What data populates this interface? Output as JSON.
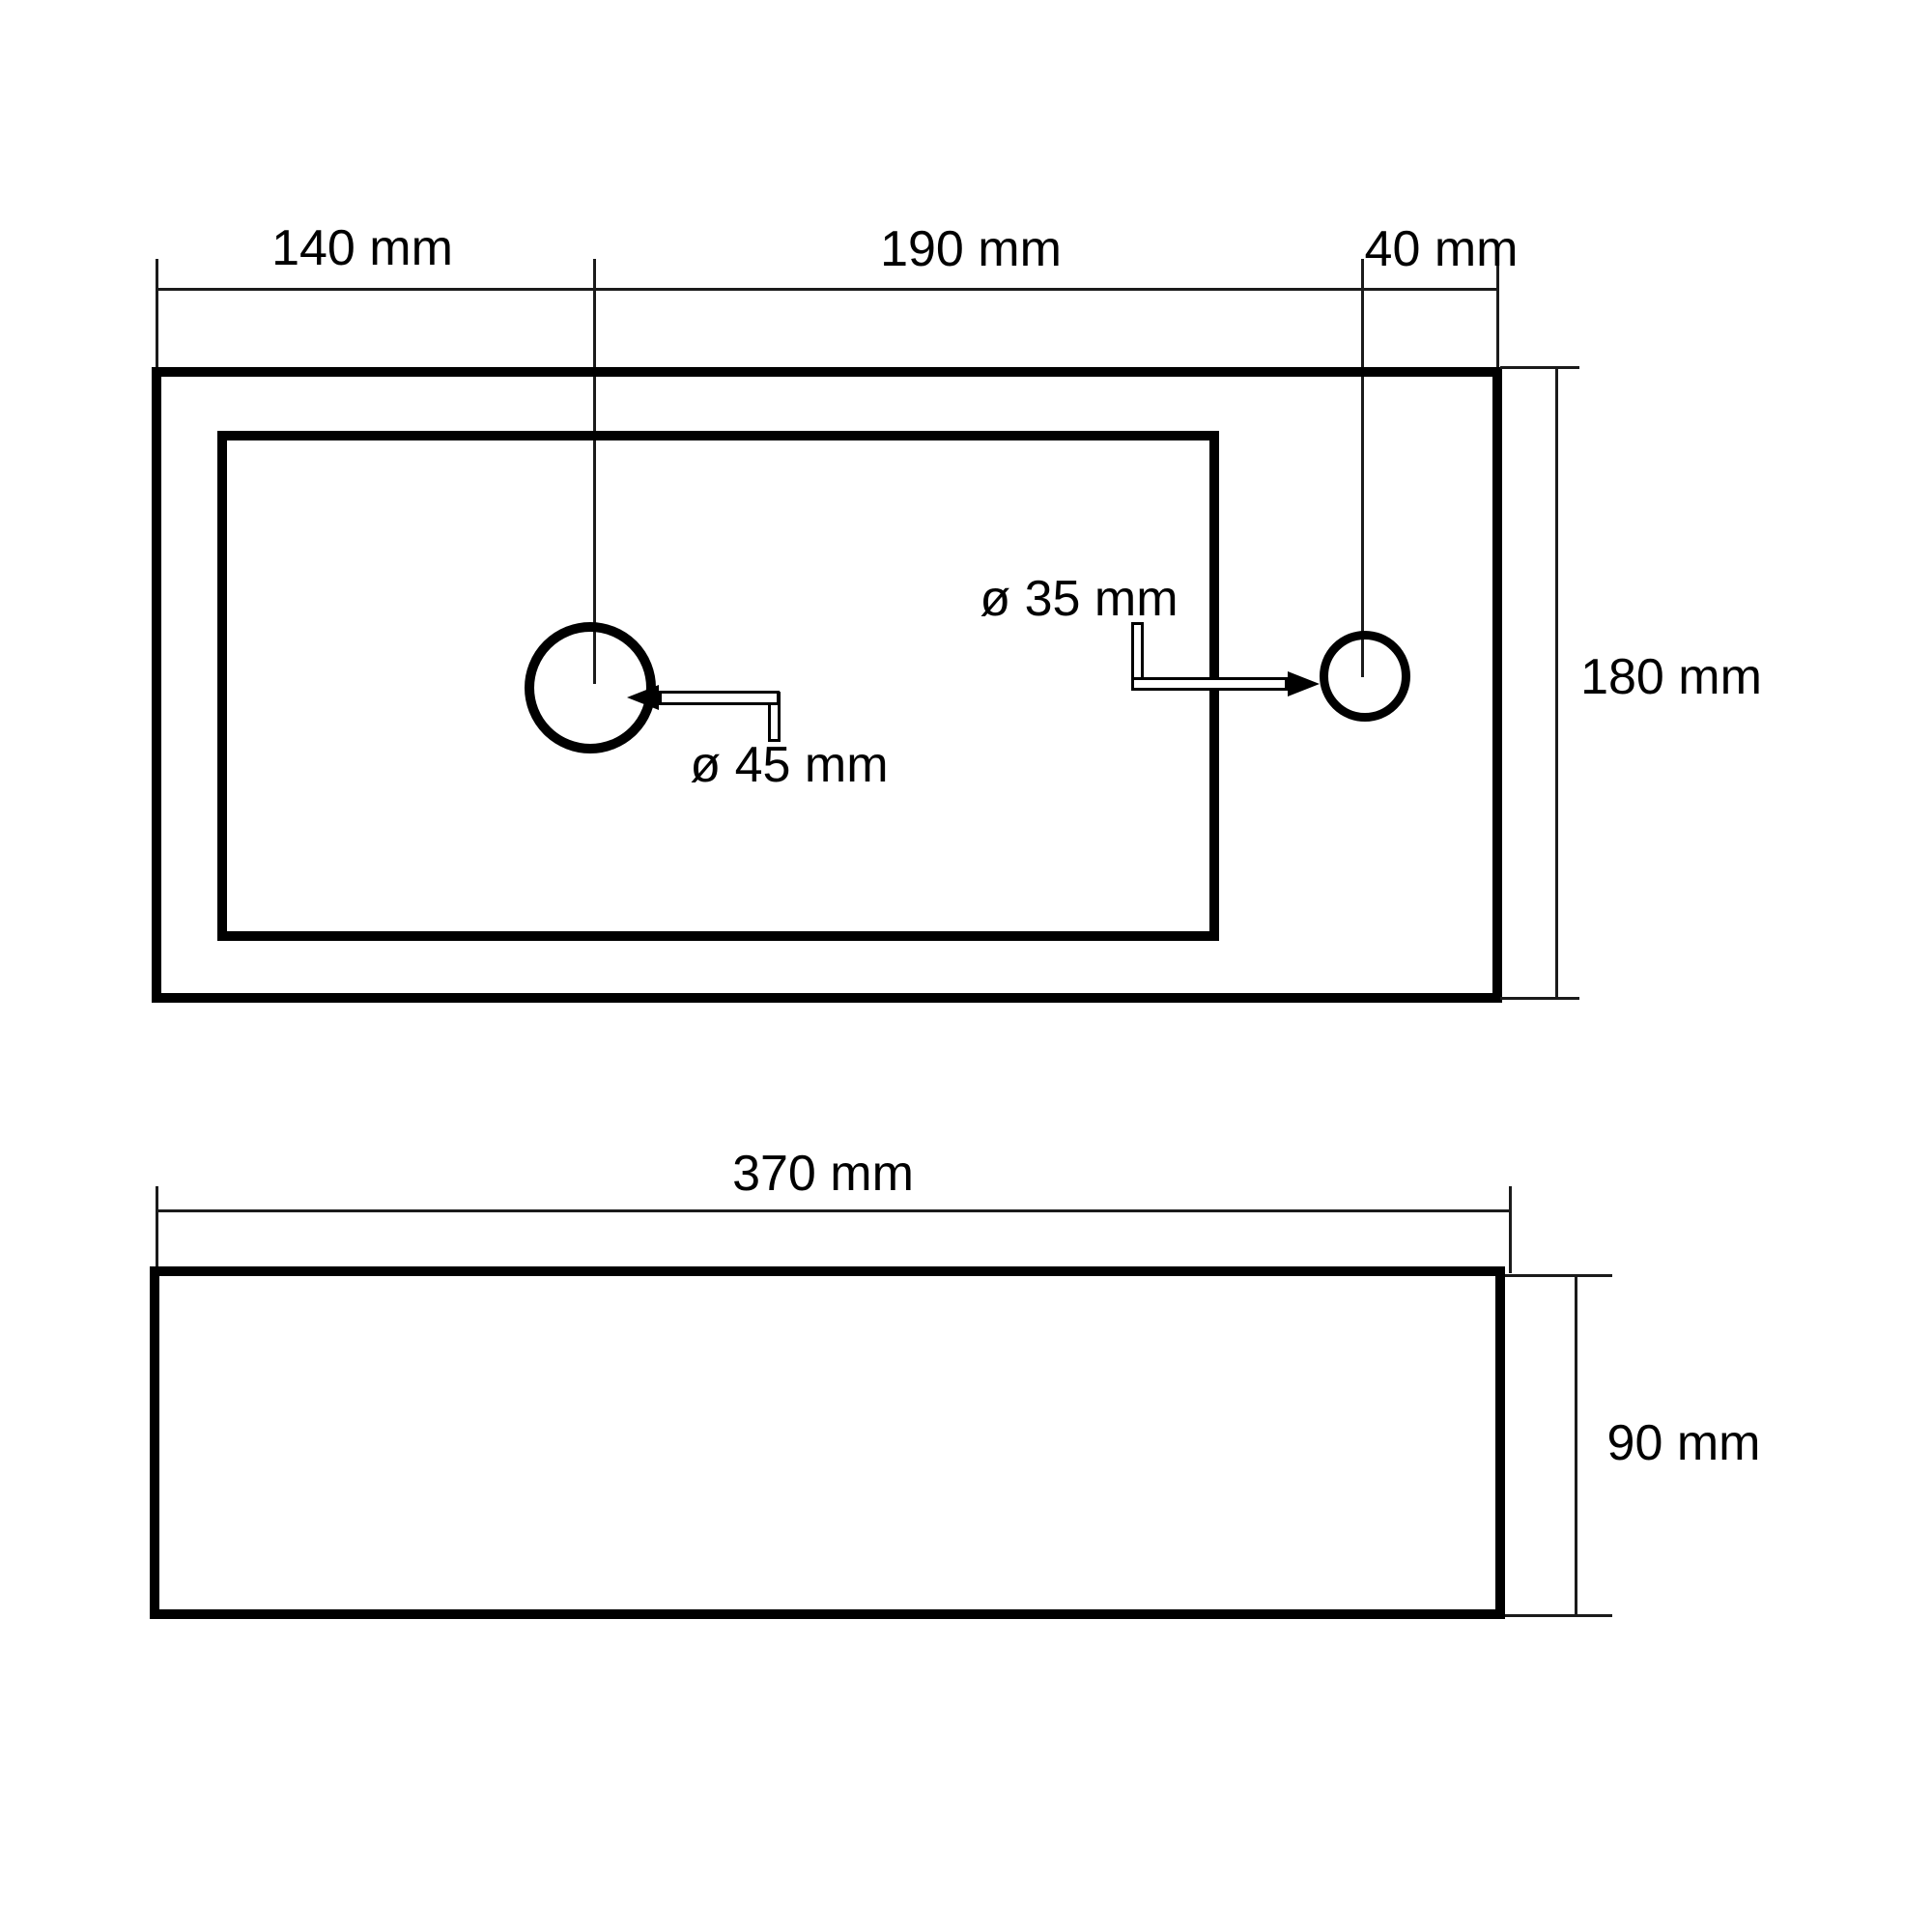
{
  "drawing": {
    "type": "sink-dimension-drawing",
    "colors": {
      "line": "#000000",
      "thin_line": "#1b1b1b",
      "background": "#ffffff"
    },
    "top_view": {
      "horizontal_dimensions": [
        {
          "label": "140 mm",
          "value": 140,
          "unit": "mm"
        },
        {
          "label": "190 mm",
          "value": 190,
          "unit": "mm"
        },
        {
          "label": "40 mm",
          "value": 40,
          "unit": "mm"
        }
      ],
      "vertical_dimension": {
        "label": "180 mm",
        "value": 180,
        "unit": "mm"
      },
      "holes": [
        {
          "name": "drain-hole",
          "label": "ø 45 mm",
          "diameter_mm": 45
        },
        {
          "name": "tap-hole",
          "label": "ø 35 mm",
          "diameter_mm": 35
        }
      ]
    },
    "front_view": {
      "width_dimension": {
        "label": "370 mm",
        "value": 370,
        "unit": "mm"
      },
      "height_dimension": {
        "label": "90 mm",
        "value": 90,
        "unit": "mm"
      }
    }
  }
}
